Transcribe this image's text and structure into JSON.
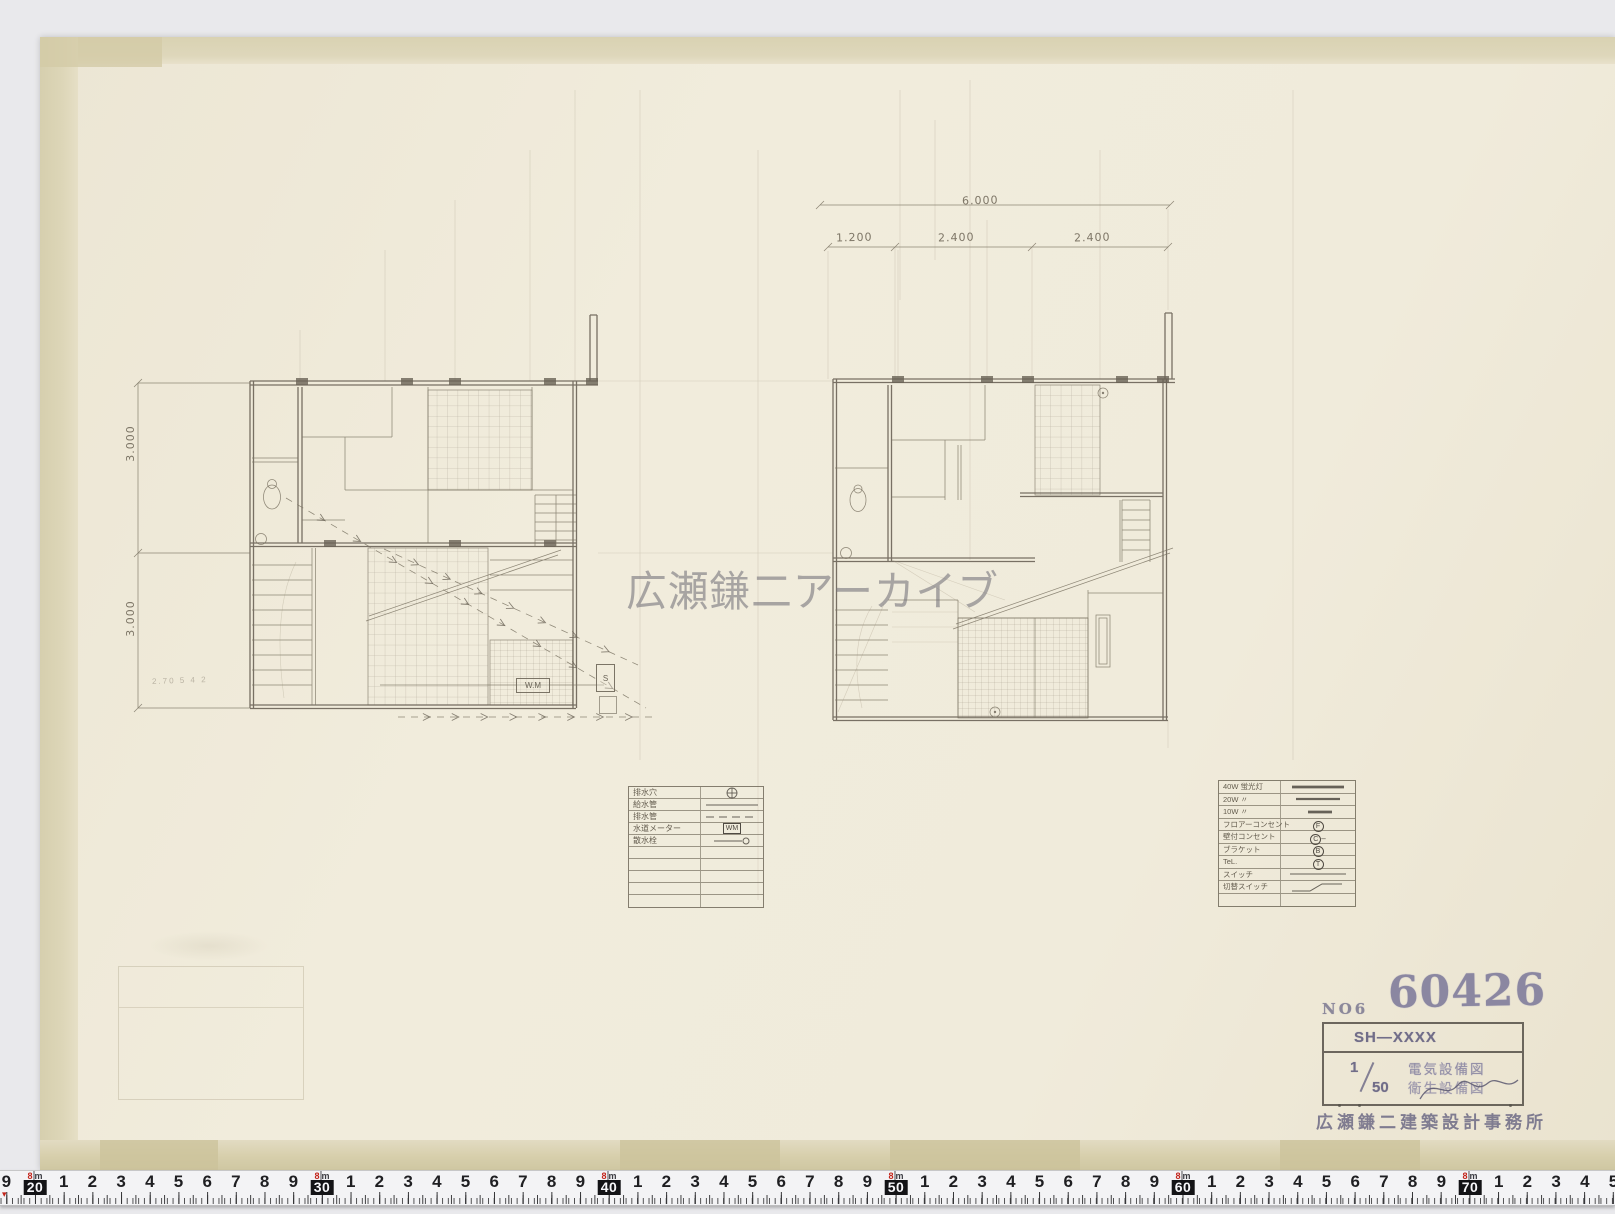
{
  "watermark": "広瀬鎌二アーカイブ",
  "plans": {
    "left": {
      "dim_top": "3.000",
      "dim_bottom": "3.000",
      "pencil_note": "2.70 5 4 2",
      "wm_label": "W.M",
      "s_label": "S"
    },
    "right": {
      "dim_total": "6.000",
      "dim_segments": [
        "1.200",
        "2.400",
        "2.400"
      ]
    }
  },
  "legend_left": {
    "rows": [
      {
        "label": "排水穴",
        "sym": "circle-cross"
      },
      {
        "label": "給水管",
        "sym": "solid-line"
      },
      {
        "label": "排水管",
        "sym": "dash-line"
      },
      {
        "label": "水道メーター",
        "sym": "box-text",
        "sym_text": "WM"
      },
      {
        "label": "散水栓",
        "sym": "line-circle"
      }
    ],
    "empty_rows": 5
  },
  "legend_right": {
    "rows": [
      {
        "label": "40W 蛍光灯",
        "sym": "thick-line"
      },
      {
        "label": "20W 〃",
        "sym": "med-line"
      },
      {
        "label": "10W 〃",
        "sym": "short-dash"
      },
      {
        "label": "フロアーコンセント",
        "sym": "circ",
        "sym_text": "F"
      },
      {
        "label": "壁付コンセント",
        "sym": "circ-tail",
        "sym_text": "C"
      },
      {
        "label": "ブラケット",
        "sym": "circ",
        "sym_text": "B"
      },
      {
        "label": "TeL.",
        "sym": "circ",
        "sym_text": "T"
      },
      {
        "label": "スイッチ",
        "sym": "thin-line"
      },
      {
        "label": "切替スイッチ",
        "sym": "step-line"
      }
    ],
    "empty_rows": 1
  },
  "title_block": {
    "no_label": "NO6",
    "number": "60426",
    "code": "SH—XXXX",
    "scale_num": "1",
    "scale_den": "50",
    "drawing_line1": "電気設備図",
    "drawing_line2": "衛生設備図",
    "office": "広瀬鎌二建築設計事務所"
  },
  "ruler": {
    "meter_digit": "8",
    "meter_unit": "m",
    "cells": [
      {
        "label": "9"
      },
      {
        "label": "20",
        "boxed": true
      },
      {
        "label": "1"
      },
      {
        "label": "2"
      },
      {
        "label": "3"
      },
      {
        "label": "4"
      },
      {
        "label": "5"
      },
      {
        "label": "6"
      },
      {
        "label": "7"
      },
      {
        "label": "8"
      },
      {
        "label": "9"
      },
      {
        "label": "30",
        "boxed": true
      },
      {
        "label": "1"
      },
      {
        "label": "2"
      },
      {
        "label": "3"
      },
      {
        "label": "4"
      },
      {
        "label": "5"
      },
      {
        "label": "6"
      },
      {
        "label": "7"
      },
      {
        "label": "8"
      },
      {
        "label": "9"
      },
      {
        "label": "40",
        "boxed": true
      },
      {
        "label": "1"
      },
      {
        "label": "2"
      },
      {
        "label": "3"
      },
      {
        "label": "4"
      },
      {
        "label": "5"
      },
      {
        "label": "6"
      },
      {
        "label": "7"
      },
      {
        "label": "8"
      },
      {
        "label": "9"
      },
      {
        "label": "50",
        "boxed": true
      },
      {
        "label": "1"
      },
      {
        "label": "2"
      },
      {
        "label": "3"
      },
      {
        "label": "4"
      },
      {
        "label": "5"
      },
      {
        "label": "6"
      },
      {
        "label": "7"
      },
      {
        "label": "8"
      },
      {
        "label": "9"
      },
      {
        "label": "60",
        "boxed": true
      },
      {
        "label": "1"
      },
      {
        "label": "2"
      },
      {
        "label": "3"
      },
      {
        "label": "4"
      },
      {
        "label": "5"
      },
      {
        "label": "6"
      },
      {
        "label": "7"
      },
      {
        "label": "8"
      },
      {
        "label": "9"
      },
      {
        "label": "70",
        "boxed": true
      },
      {
        "label": "1"
      },
      {
        "label": "2"
      },
      {
        "label": "3"
      },
      {
        "label": "4"
      },
      {
        "label": "5"
      }
    ]
  }
}
